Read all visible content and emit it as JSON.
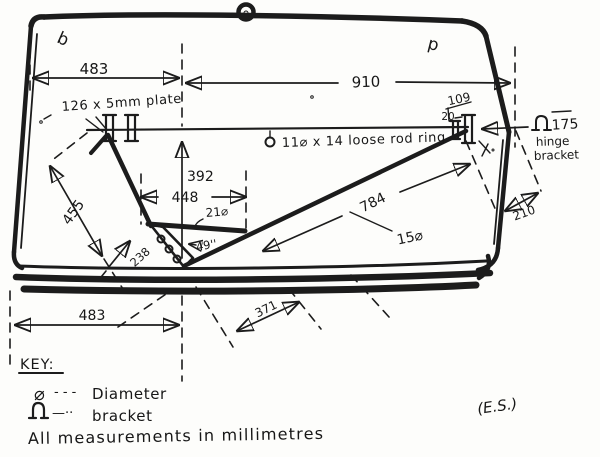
{
  "diagram": {
    "marks": {
      "left": "b",
      "right": "p"
    },
    "dimensions": {
      "top_width_left": "483",
      "top_width_right": "910",
      "plate_note": "126 x 5mm plate",
      "rod_ring_note": "11⌀ x 14 loose rod ring",
      "bracket_offset": "109",
      "bracket_gap": "20",
      "hinge_symbol": "⌂",
      "hinge_value": "175",
      "hinge_line1": "hinge",
      "hinge_line2": "bracket",
      "vertical_drop": "392",
      "vee_width": "448",
      "left_diagonal": "455",
      "bar_diameter": "21⌀",
      "hole_spacing": "49''",
      "vee_left": "238",
      "rod_length": "784",
      "rod_diameter": "15⌀",
      "right_offset": "210",
      "bottom_width": "483",
      "bottom_offset": "371"
    },
    "key": {
      "title": "KEY:",
      "items": [
        {
          "symbol": "⌀",
          "dashes": "- - -",
          "label": "Diameter"
        },
        {
          "symbol": "⌂",
          "dashes": "—··",
          "label": "bracket"
        }
      ],
      "note": "All measurements in millimetres"
    },
    "signature": "(E.S.)"
  }
}
